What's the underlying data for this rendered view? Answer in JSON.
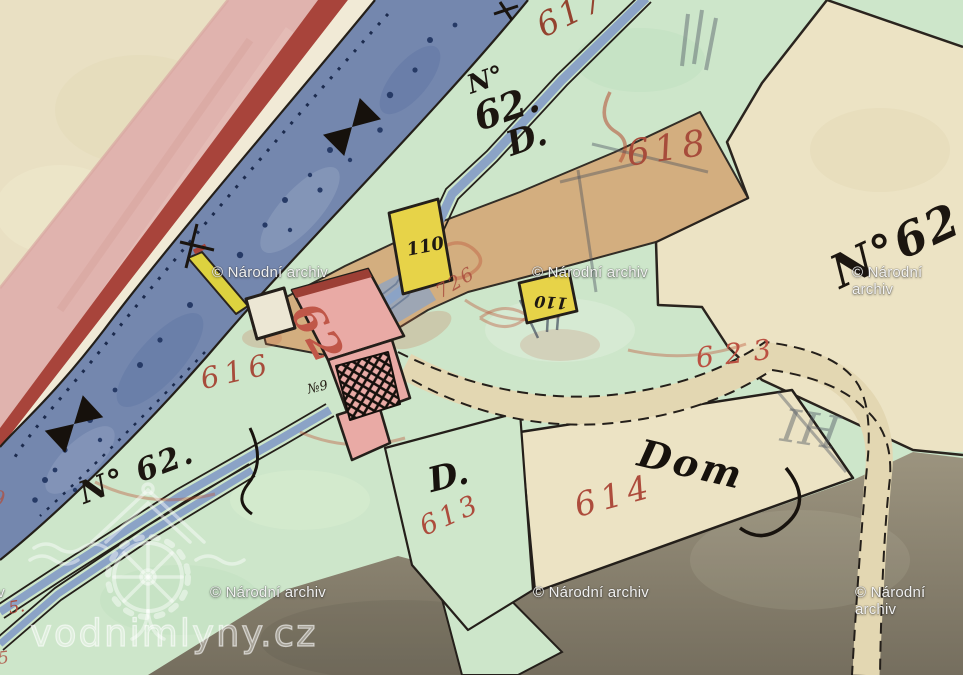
{
  "source": {
    "archive_watermark": "© Národní archiv",
    "site_watermark": "vodnimlyny.cz"
  },
  "map": {
    "red_parcel_numbers": [
      {
        "key": "p617",
        "text": "617"
      },
      {
        "key": "p618",
        "text": "618"
      },
      {
        "key": "p616",
        "text": "616"
      },
      {
        "key": "p613",
        "text": "613"
      },
      {
        "key": "p614",
        "text": "614"
      },
      {
        "key": "p623",
        "text": "623"
      },
      {
        "key": "p726",
        "text": "726"
      },
      {
        "key": "edge9",
        "text": "9"
      },
      {
        "key": "five_a",
        "text": "5."
      },
      {
        "key": "five_b",
        "text": "5"
      }
    ],
    "house_numbers": [
      {
        "key": "mill62",
        "text": "62"
      },
      {
        "key": "h110a",
        "text": "110"
      },
      {
        "key": "h110b",
        "text": "110"
      },
      {
        "key": "no9",
        "text": "№9"
      }
    ],
    "script_labels": {
      "top": {
        "line1": "N°",
        "line2": "62.",
        "line3": "D."
      },
      "left": "N° 62.",
      "right": "N°62",
      "d": "D.",
      "dom": "Dom"
    },
    "pencil_marks": [
      {
        "key": "ih",
        "text": "IH"
      }
    ],
    "palette": {
      "paper": "#e9e0c3",
      "road_pink": "#e0b3ae",
      "road_stripe": "#a8443b",
      "stream_blue": "#7487ae",
      "meadow_green": "#cde6ca",
      "building_yellow": "#e7d348",
      "building_pink": "#e9aaa5",
      "parcel_beige": "#ece3c4",
      "field_gray": "#8d8677",
      "red_ink": "#a74c3b",
      "black_ink": "#1d1812"
    }
  }
}
